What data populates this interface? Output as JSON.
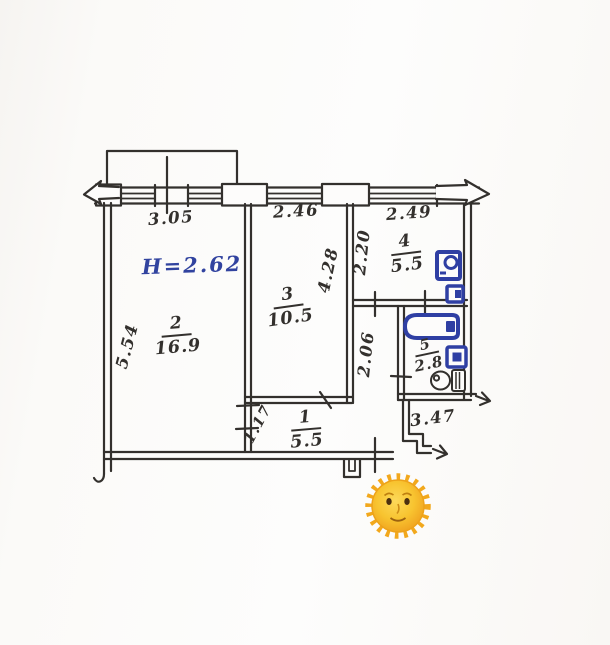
{
  "plan": {
    "height_note": "H=2.62",
    "dims": {
      "top_left": "3.05",
      "top_mid": "2.46",
      "top_right": "2.49",
      "left_side": "5.54",
      "room3_depth": "4.28",
      "kitchen_depth": "2.20",
      "corridor": "2.06",
      "hall_left": "1.17",
      "hall_bottom": "3.47"
    },
    "rooms": [
      {
        "id": "living",
        "number": "2",
        "area": "16.9"
      },
      {
        "id": "bedroom",
        "number": "3",
        "area": "10.5"
      },
      {
        "id": "kitchen",
        "number": "4",
        "area": "5.5"
      },
      {
        "id": "bathroom",
        "number": "5",
        "area": "2.8"
      },
      {
        "id": "hallway",
        "number": "1",
        "area": "5.5"
      }
    ],
    "icons": {
      "sun": "sun-with-face-emoji",
      "fixtures": [
        "stove-icon",
        "kitchen-sink-icon",
        "bathtub-icon",
        "bath-sink-icon",
        "toilet-icon"
      ]
    },
    "colors": {
      "ink": "#33302d",
      "blue_ink": "#31439f",
      "fixture_blue": "#2f3fa3",
      "paper": "#fbfaf8",
      "sun_core": "#f8c430",
      "sun_edge": "#efa01e"
    }
  }
}
